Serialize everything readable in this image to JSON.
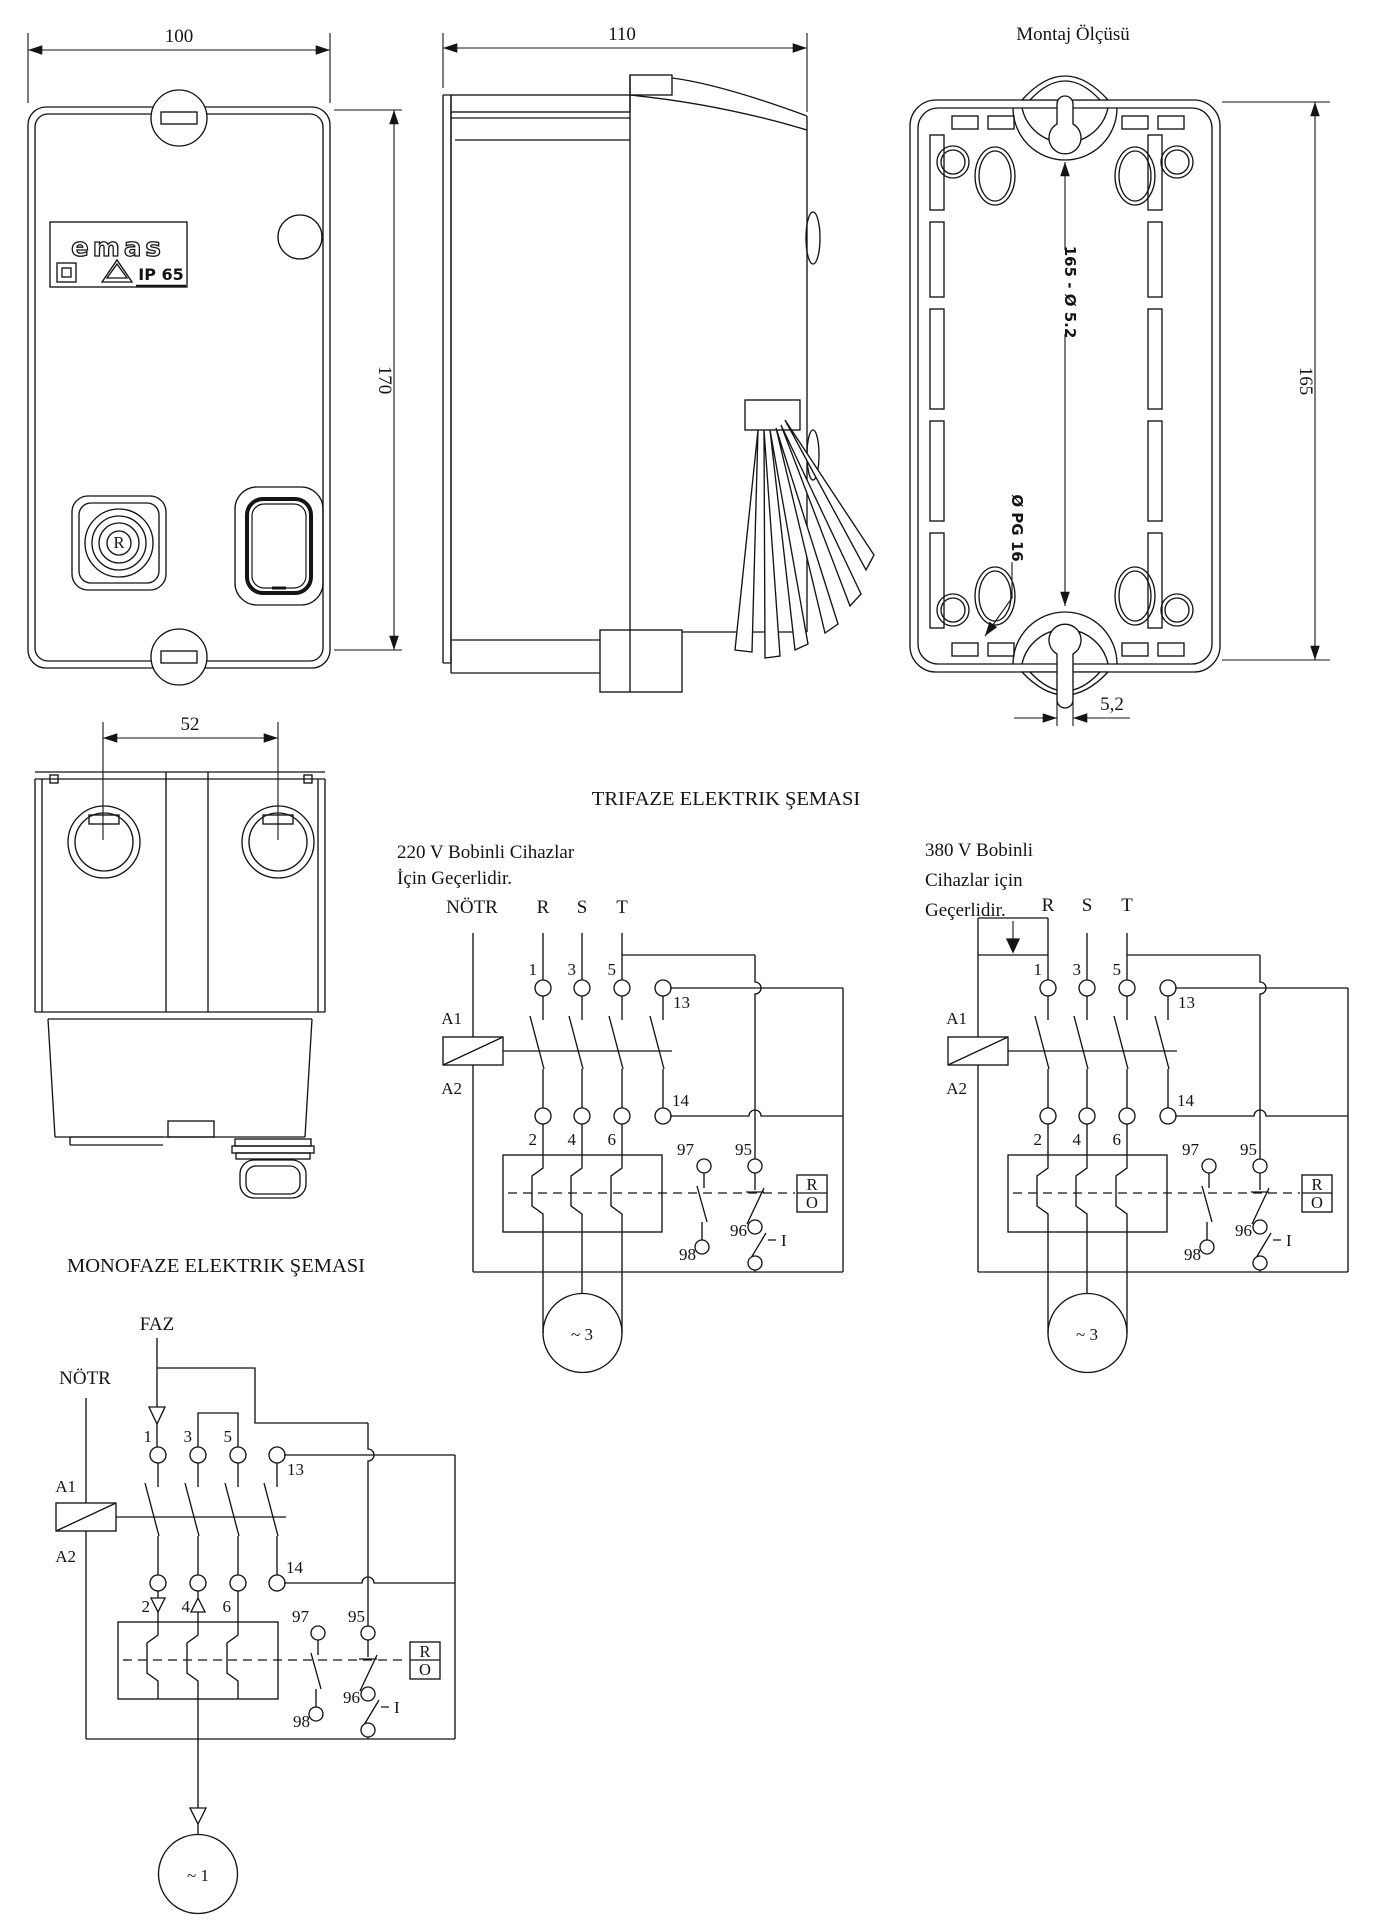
{
  "front_view": {
    "dim_width": "100",
    "dim_height": "170",
    "logo_brand": "emas",
    "logo_ip": "IP 65",
    "reset_label": "R"
  },
  "side_view": {
    "dim_depth": "110"
  },
  "mounting_view": {
    "title": "Montaj Ölçüsü",
    "dim_height": "165",
    "dim_hole_pattern": "165 - Ø 5.2",
    "dim_gland": "Ø PG 16",
    "dim_slot": "5,2"
  },
  "bottom_view": {
    "dim_spacing": "52"
  },
  "trifaze": {
    "title": "TRIFAZE ELEKTRIK ŞEMASI",
    "note_220": [
      "220 V Bobinli Cihazlar",
      "İçin Geçerlidir."
    ],
    "note_380": [
      "380 V Bobinli",
      "Cihazlar için",
      "Geçerlidir."
    ],
    "neutral": "NÖTR",
    "phases": [
      "R",
      "S",
      "T"
    ],
    "motor_label": "~ 3"
  },
  "monofaze": {
    "title": "MONOFAZE ELEKTRIK ŞEMASI",
    "phase": "FAZ",
    "neutral": "NÖTR",
    "motor_label": "~ 1"
  },
  "terminals": {
    "t1": "1",
    "t2": "2",
    "t3": "3",
    "t4": "4",
    "t5": "5",
    "t6": "6",
    "a1": "A1",
    "a2": "A2",
    "aux_top": "13",
    "aux_bottom": "14",
    "ol_nc_top": "95",
    "ol_nc_bottom": "96",
    "ol_no_top": "97",
    "ol_no_bottom": "98",
    "start": "I",
    "reset_r": "R",
    "reset_o": "O"
  }
}
